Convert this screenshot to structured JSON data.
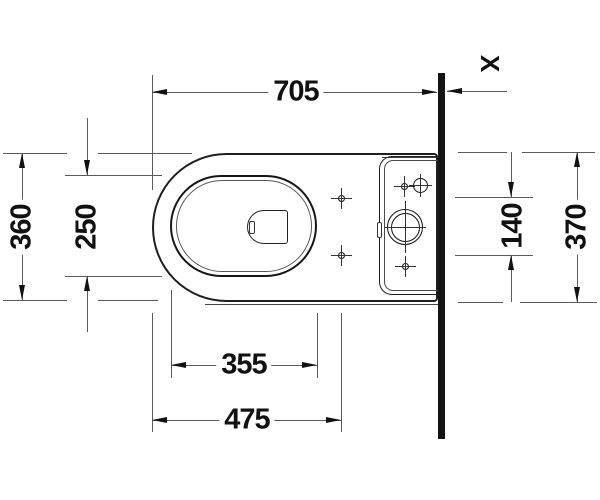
{
  "labels": {
    "overall_depth": "705",
    "bowl_width": "360",
    "bowl_inner_width": "250",
    "bowl_inner_length": "355",
    "front_to_fixing_holes": "475",
    "fixing_hole_spacing": "140",
    "tank_width": "370",
    "wall_distance": "X"
  },
  "colors": {
    "main_line": "#1f1f1f",
    "thin_line": "#5a5a5a",
    "text": "#111111",
    "background": "#ffffff"
  }
}
